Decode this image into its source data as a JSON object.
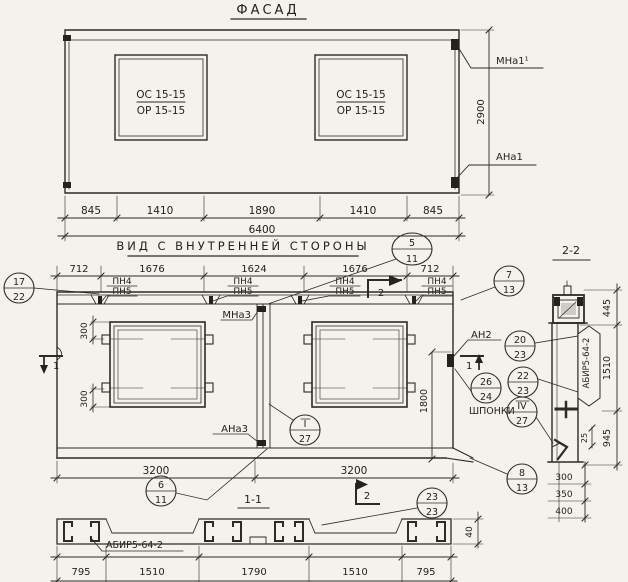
{
  "colors": {
    "paper": "#f3f2ec",
    "ink": "#2c2b27"
  },
  "facade": {
    "title": "ФАСАД",
    "window_mark_top": "ОС 15-15",
    "window_mark_bottom": "ОР 15-15",
    "label_anchor_top": "МНа1¹",
    "label_anchor_bottom": "АНа1",
    "dim_height": "2900",
    "dims": [
      "845",
      "1410",
      "1890",
      "1410",
      "845"
    ],
    "dim_total": "6400"
  },
  "inner": {
    "title": "ВИД С ВНУТРЕННЕЙ СТОРОНЫ",
    "dims_top": [
      "712",
      "1676",
      "1624",
      "1676",
      "712"
    ],
    "lintel_label_top": "ПН4",
    "lintel_label_bottom": "ПН5",
    "joint_label_top": "МНа3",
    "joint_label_bottom": "АНа3",
    "anchor_label": "АН2",
    "keys_label": "ШПОНКИ",
    "dim_tab": "300",
    "dim_right": "1800",
    "dims_bottom": [
      "3200",
      "3200"
    ]
  },
  "cut_marks": {
    "mark_1": "1",
    "mark_2": "2"
  },
  "section_1_1": {
    "title": "1-1",
    "panel_mark": "АБИР5-64-2",
    "dims": [
      "795",
      "1510",
      "1790",
      "1510",
      "795"
    ],
    "dim_flange": "40"
  },
  "section_2_2": {
    "title": "2-2",
    "panel_mark": "АБИР5-64-2",
    "dims_right": [
      "445",
      "1510",
      "945"
    ],
    "dim_key": "25",
    "dims_bottom": [
      "300",
      "350",
      "400"
    ]
  },
  "callouts": {
    "c17_22": {
      "top": "17",
      "bottom": "22"
    },
    "c5_11": {
      "top": "5",
      "bottom": "11"
    },
    "c7_13": {
      "top": "7",
      "bottom": "13"
    },
    "c20_23": {
      "top": "20",
      "bottom": "23"
    },
    "c22_23": {
      "top": "22",
      "bottom": "23"
    },
    "c26_24": {
      "top": "26",
      "bottom": "24"
    },
    "c4_27": {
      "top": "IV",
      "bottom": "27"
    },
    "c1_27": {
      "top": "I",
      "bottom": "27"
    },
    "c6_11": {
      "top": "6",
      "bottom": "11"
    },
    "c8_13": {
      "top": "8",
      "bottom": "13"
    },
    "c23_23": {
      "top": "23",
      "bottom": "23"
    }
  }
}
